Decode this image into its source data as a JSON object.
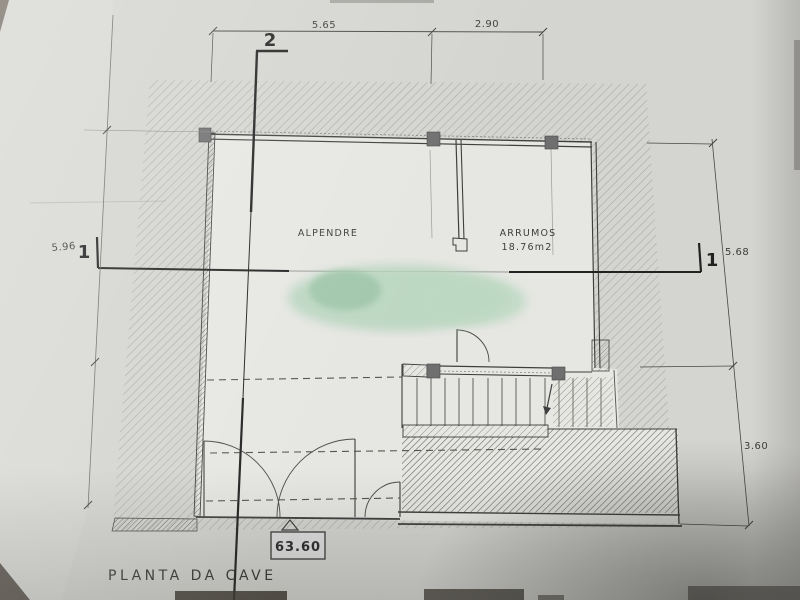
{
  "document": {
    "title": "PLANTA DA CAVE",
    "rooms": {
      "alpendre": "ALPENDRE",
      "arrumos": "ARRUMOS",
      "arrumos_area": "18.76m2"
    },
    "dimensions": {
      "top_left_width": "5.65",
      "top_right_width": "2.90",
      "left_height": "5.96",
      "right_upper_height": "5.68",
      "right_lower_height": "3.60"
    },
    "floor_level": "63.60",
    "section_marker_vertical": "2",
    "section_marker_horizontal": "1"
  },
  "colors": {
    "paper": "#d4d4d0",
    "plan_background": "#e6e6e2",
    "ink": "#3f3f3f",
    "stamp_green": "#aecfb8"
  }
}
